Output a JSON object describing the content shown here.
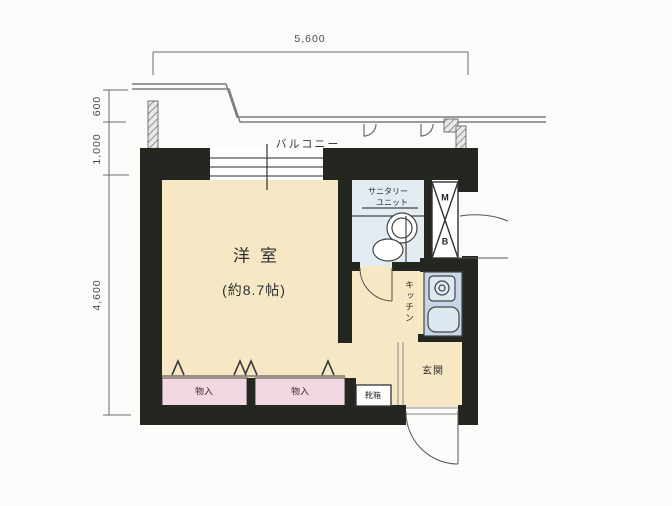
{
  "dimensions": {
    "top_width": "5,600",
    "left_upper": "600",
    "left_middle": "1,000",
    "left_lower": "4,600"
  },
  "rooms": {
    "balcony": {
      "label": "バルコニー"
    },
    "main_room": {
      "label": "洋室",
      "size": "(約8.7帖)"
    },
    "sanitary": {
      "label_line1": "サニタリー",
      "label_line2": "ユニット"
    },
    "kitchen": {
      "label": "キッチン"
    },
    "entrance": {
      "label": "玄関"
    },
    "storage_left": {
      "label": "物入"
    },
    "storage_right": {
      "label": "物入"
    },
    "shoe_cabinet": {
      "label": "靴箱"
    },
    "meter_box": {
      "letter_top": "M",
      "letter_bottom": "B"
    }
  },
  "colors": {
    "wall": "#242720",
    "room_floor": "#f7e8c5",
    "closet_fill": "#f3d7e3",
    "sanitary_fill": "#e3ecf2",
    "kitchen_counter": "#c7d6e6",
    "fixture_fill": "#dde8f1",
    "dim_text": "#4c4c4c",
    "background": "#fbfbf9"
  }
}
